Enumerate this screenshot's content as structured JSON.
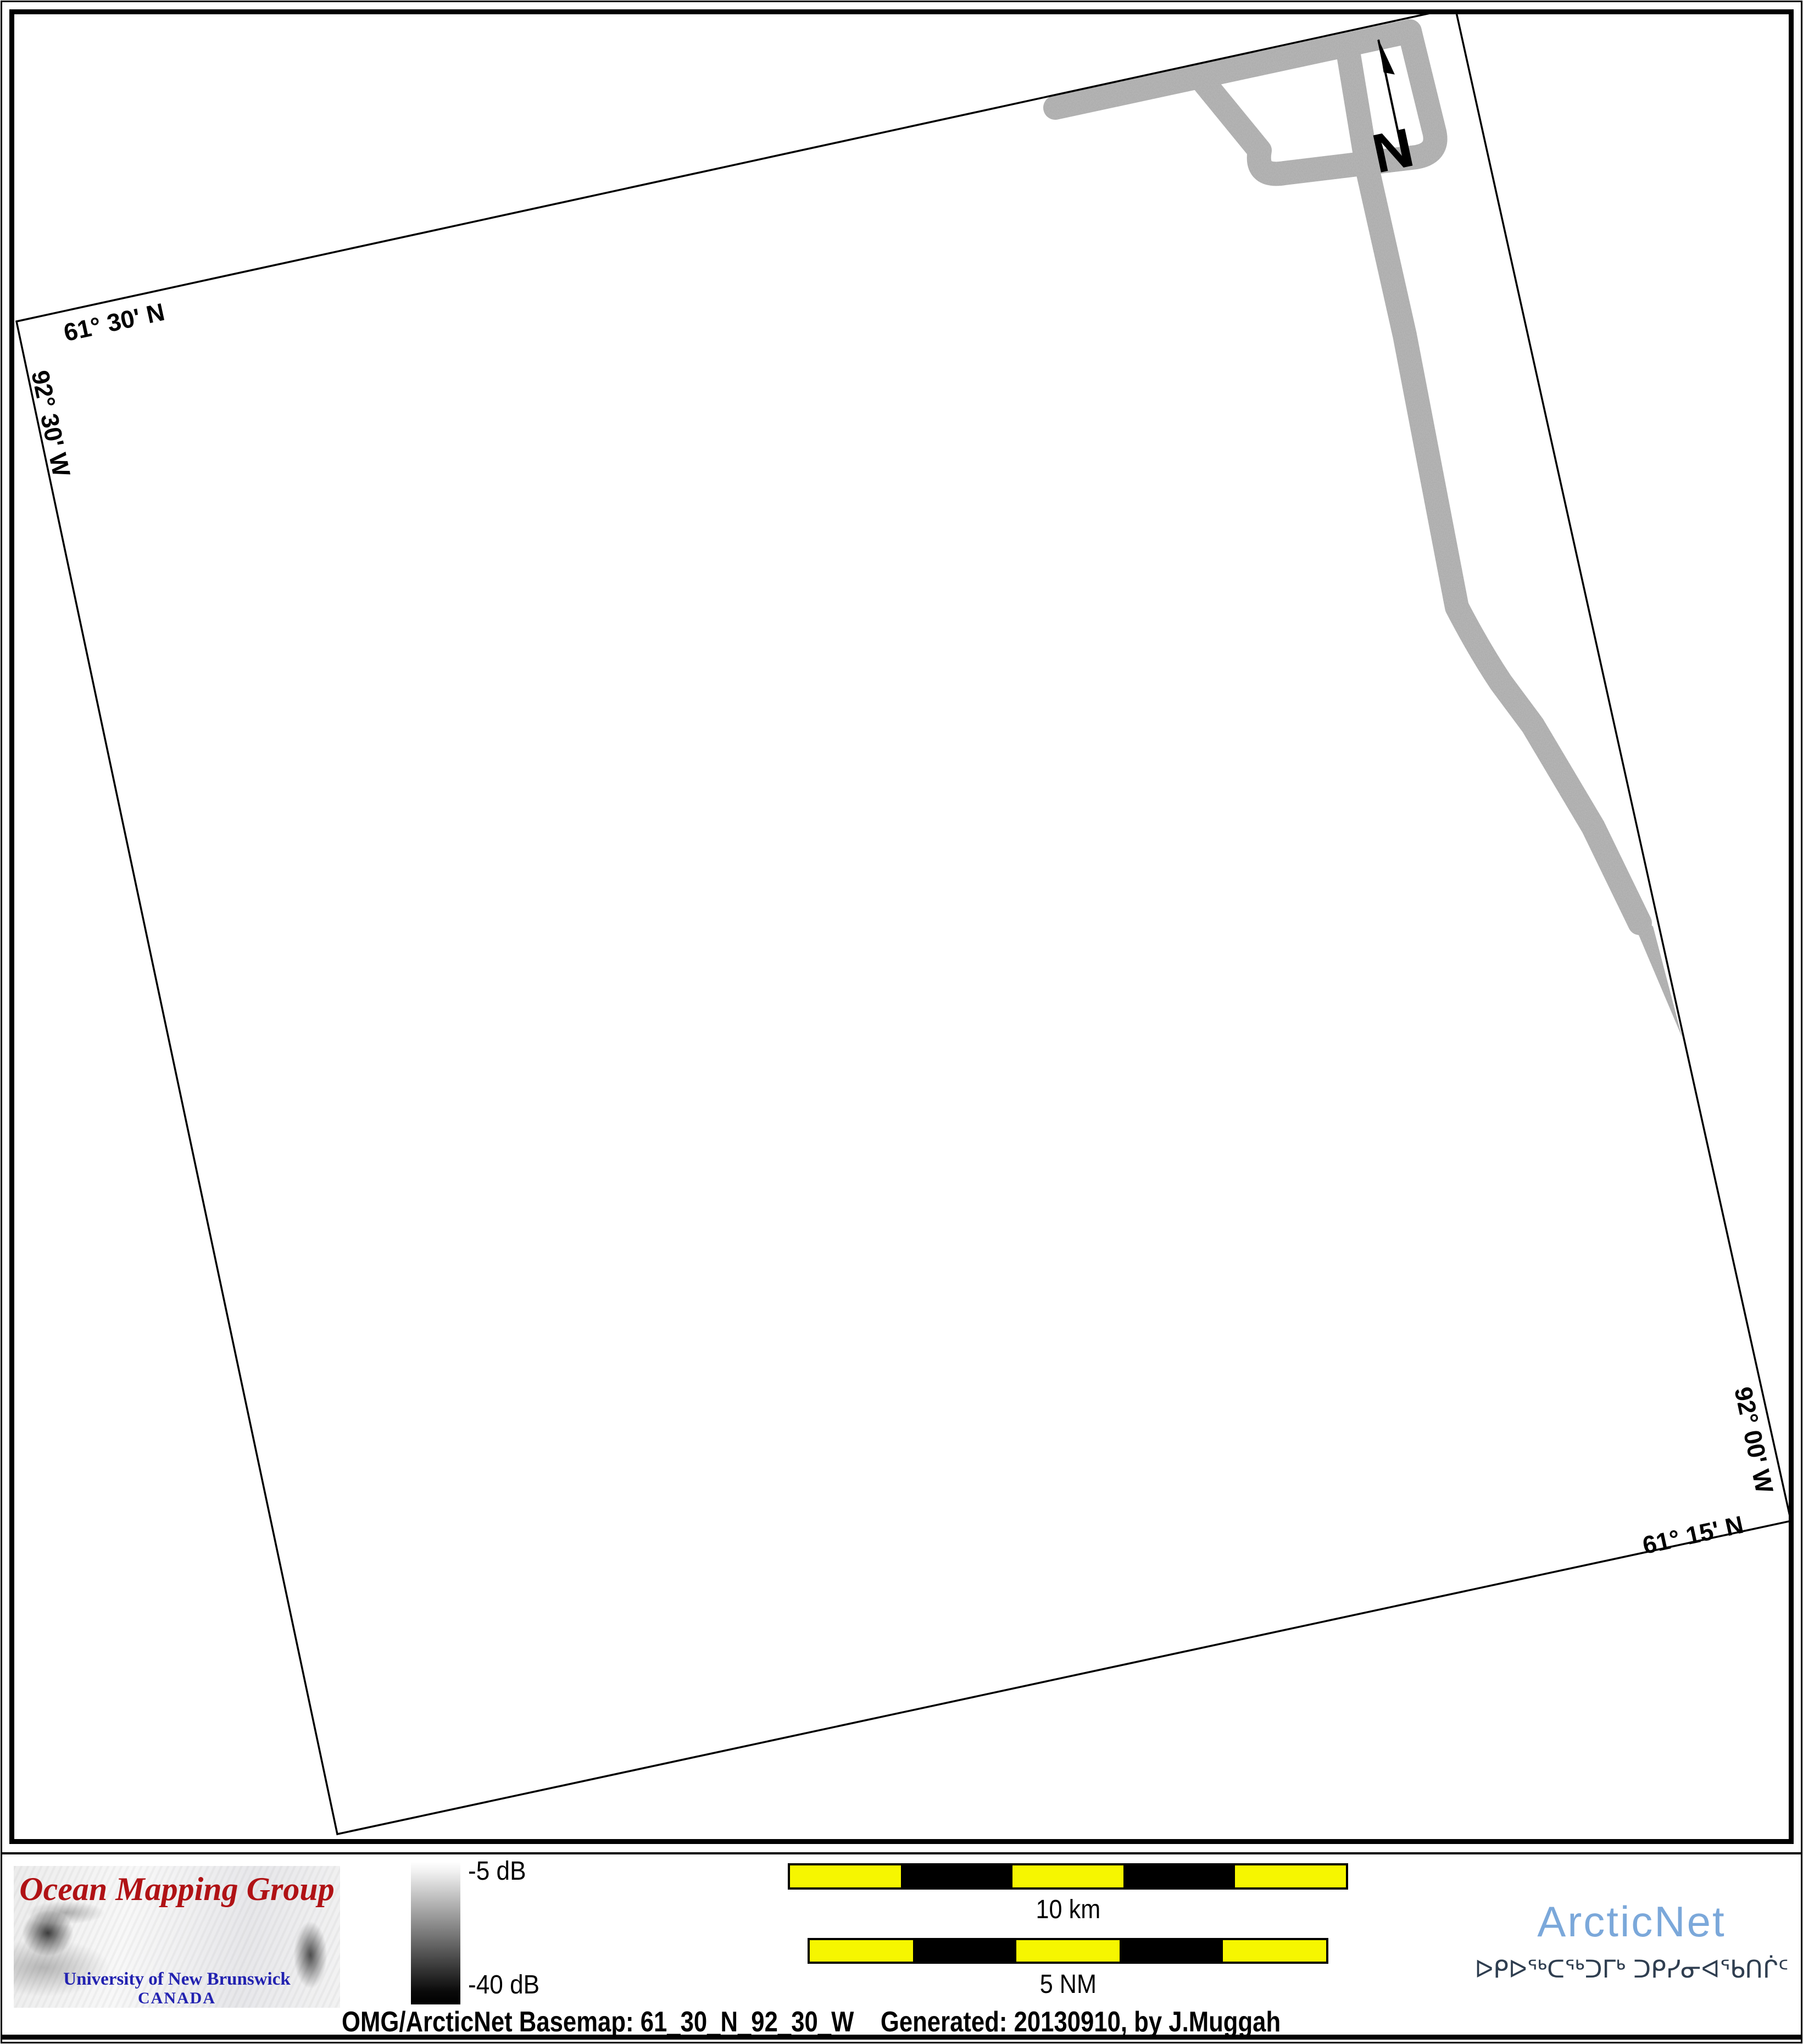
{
  "map": {
    "graticule_labels": {
      "top_lat": "61° 30' N",
      "left_lon": "92° 30' W",
      "right_lon": "92° 00' W",
      "bottom_lat": "61° 15' N"
    },
    "north_arrow_label": "N"
  },
  "footer": {
    "omg_logo": {
      "title": "Ocean Mapping Group",
      "subtitle": "University of New Brunswick",
      "country": "CANADA"
    },
    "colorbar": {
      "top_label": "-5 dB",
      "bottom_label": "-40 dB",
      "top_value_db": -5,
      "bottom_value_db": -40
    },
    "scalebars": {
      "km": {
        "label": "10 km",
        "segments": 5
      },
      "nm": {
        "label": "5 NM",
        "segments": 5
      }
    },
    "arcticnet": {
      "name": "ArcticNet",
      "inuktitut": "ᐅᑭᐅᖅᑕᖅᑐᒥᒃ ᑐᑭᓯᓂᐊᖃᑎᒌᑦ"
    },
    "caption": "OMG/ArcticNet Basemap: 61_30_N_92_30_W    Generated: 20130910, by J.Muggah"
  },
  "colors": {
    "scalebar_yellow": "#f6f600",
    "arcticnet_blue": "#7ba8da",
    "inuktitut_navy": "#2f3e50",
    "omg_red": "#b01215",
    "omg_blue": "#2222b0",
    "swath_gray": "#a8a8a8",
    "frame_black": "#000000"
  }
}
